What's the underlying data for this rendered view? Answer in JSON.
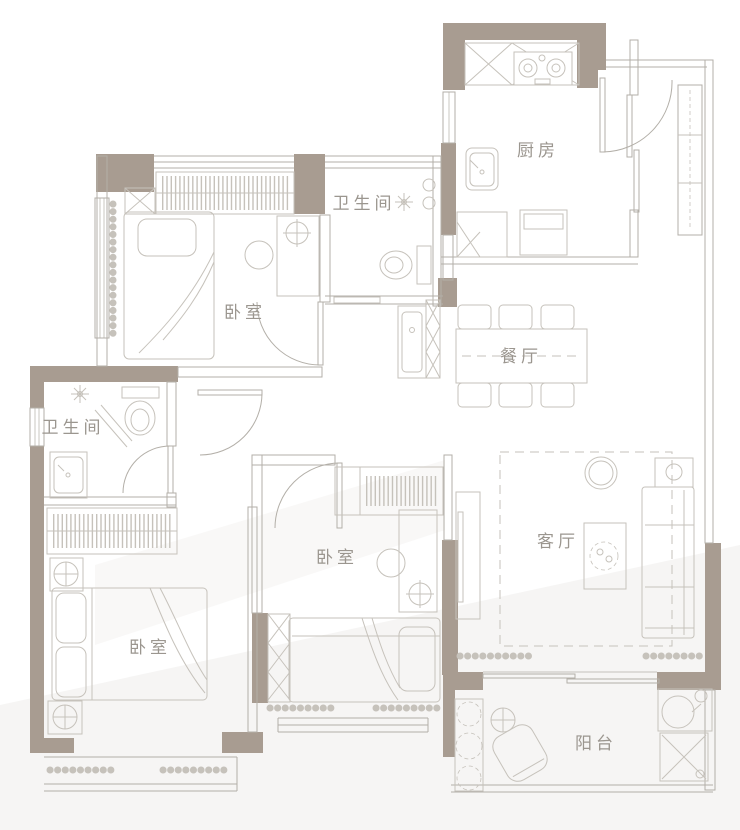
{
  "plan": {
    "type": "apartment-floor-plan",
    "rooms": {
      "bedroom_top": {
        "label": "卧室"
      },
      "bathroom_top": {
        "label": "卫生间"
      },
      "kitchen": {
        "label": "厨房"
      },
      "dining": {
        "label": "餐厅"
      },
      "bathroom_left": {
        "label": "卫生间"
      },
      "bedroom_left": {
        "label": "卧室"
      },
      "bedroom_middle": {
        "label": "卧室"
      },
      "living": {
        "label": "客厅"
      },
      "balcony": {
        "label": "阳台"
      }
    }
  },
  "colors": {
    "wall": "#a89c91",
    "line": "#b3afa8",
    "line_soft": "#c6c2bb",
    "label": "#9b968f",
    "background": "#ffffff",
    "shade": "#f3f2f0"
  }
}
